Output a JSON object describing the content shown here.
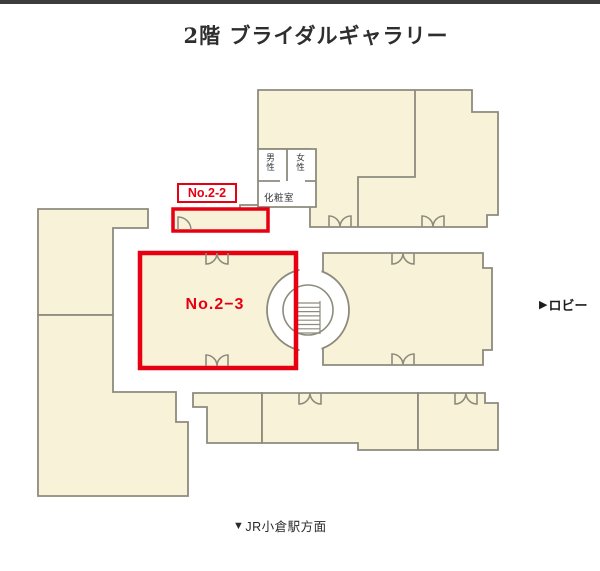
{
  "title": "2階 ブライダルギャラリー",
  "floorplan": {
    "highlight_2_2": {
      "label": "No.2-2"
    },
    "highlight_2_3": {
      "label": "No.2−3"
    },
    "facilities": {
      "toilet_men": "男性",
      "toilet_women": "女性",
      "powder_room": "化粧室"
    },
    "directions": {
      "lobby": {
        "icon": "▶",
        "text": "ロビー"
      },
      "station": {
        "icon": "▼",
        "text": "JR小倉駅方面"
      }
    },
    "colors": {
      "room_fill": "#f8f3d8",
      "wall": "#8d8b7d",
      "highlight": "#e60012",
      "top_bar": "#3d3d3d"
    }
  }
}
